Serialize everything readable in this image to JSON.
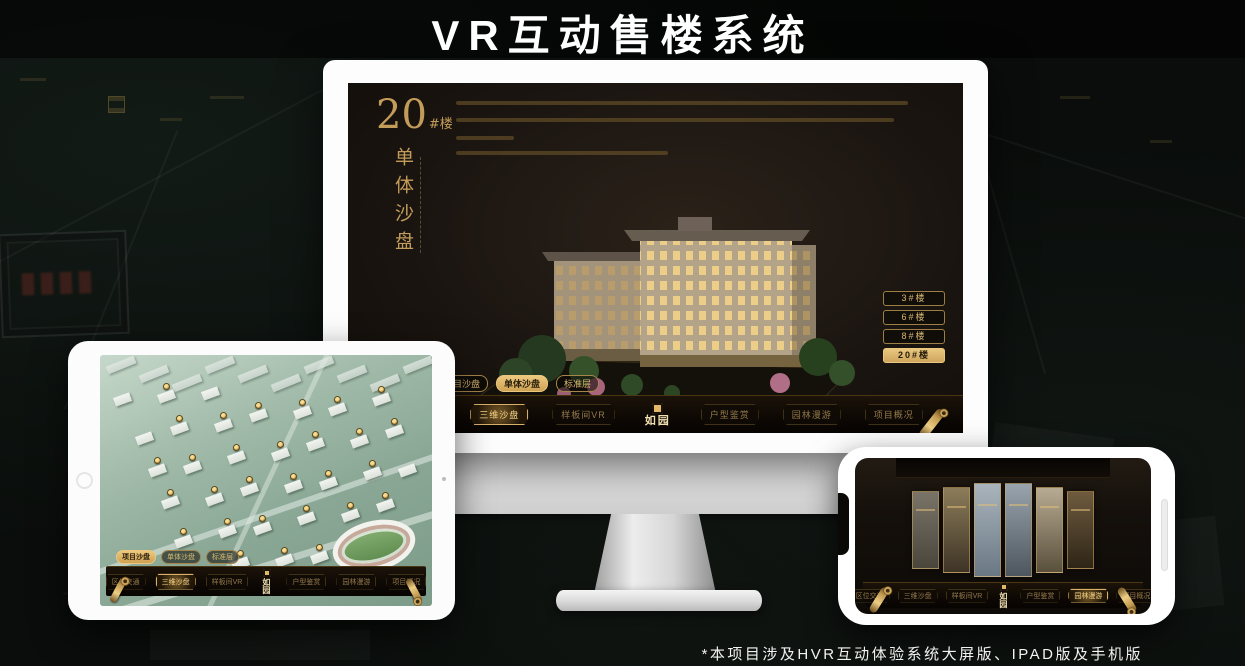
{
  "header": {
    "title": "VR互动售楼系统"
  },
  "footer": {
    "note": "*本项目涉及HVR互动体验系统大屏版、IPAD版及手机版"
  },
  "colors": {
    "gold": "#d9b26a",
    "gold_text": "#c39c59",
    "screen_dark": "#1b1511",
    "accent_active": "#ecc87e"
  },
  "monitor_ui": {
    "building_number": "20",
    "building_suffix": "#楼",
    "subtitle_vertical": "单体沙盘",
    "floor_buttons": [
      {
        "label": "3#楼",
        "active": false
      },
      {
        "label": "6#楼",
        "active": false
      },
      {
        "label": "8#楼",
        "active": false
      },
      {
        "label": "20#楼",
        "active": true
      }
    ],
    "view_tabs": [
      {
        "label": "项目沙盘",
        "active": false
      },
      {
        "label": "单体沙盘",
        "active": true
      },
      {
        "label": "标准层",
        "active": false
      }
    ],
    "nav_left": [
      {
        "label": "区位交通",
        "active": false
      },
      {
        "label": "三维沙盘",
        "active": true
      },
      {
        "label": "样板间VR",
        "active": false
      }
    ],
    "logo": "如园",
    "nav_right": [
      {
        "label": "户型鉴赏",
        "active": false
      },
      {
        "label": "园林漫游",
        "active": false
      },
      {
        "label": "项目概况",
        "active": false
      }
    ]
  },
  "tablet_ui": {
    "view_tabs": [
      {
        "label": "项目沙盘",
        "active": true
      },
      {
        "label": "单体沙盘",
        "active": false
      },
      {
        "label": "标准层",
        "active": false
      }
    ],
    "nav_left": [
      {
        "label": "区位交通",
        "active": false
      },
      {
        "label": "三维沙盘",
        "active": true
      },
      {
        "label": "样板间VR",
        "active": false
      }
    ],
    "logo": "如园",
    "nav_right": [
      {
        "label": "户型鉴赏",
        "active": false
      },
      {
        "label": "园林漫游",
        "active": false
      },
      {
        "label": "项目概况",
        "active": false
      }
    ]
  },
  "phone_ui": {
    "nav_left": [
      {
        "label": "区位交通",
        "active": false
      },
      {
        "label": "三维沙盘",
        "active": false
      },
      {
        "label": "样板间VR",
        "active": false
      }
    ],
    "logo": "如园",
    "nav_right": [
      {
        "label": "户型鉴赏",
        "active": false
      },
      {
        "label": "园林漫游",
        "active": true
      },
      {
        "label": "项目概况",
        "active": false
      }
    ]
  }
}
